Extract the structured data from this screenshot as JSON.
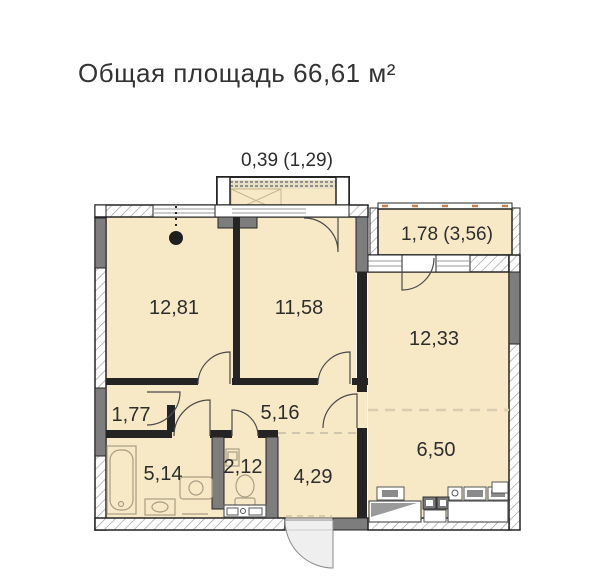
{
  "title": "Общая площадь 66,61 м²",
  "plan": {
    "balcony_top": {
      "label": "0,39 (1,29)"
    },
    "balcony_right": {
      "label": "1,78 (3,56)"
    },
    "rooms": [
      {
        "name": "bedroom-1",
        "area": "12,81"
      },
      {
        "name": "bedroom-2",
        "area": "11,58"
      },
      {
        "name": "living-room",
        "area": "12,33"
      },
      {
        "name": "entry-nook",
        "area": "1,77"
      },
      {
        "name": "corridor",
        "area": "5,16"
      },
      {
        "name": "kitchen",
        "area": "6,50"
      },
      {
        "name": "bathroom",
        "area": "5,14"
      },
      {
        "name": "wc",
        "area": "2,12"
      },
      {
        "name": "hallway",
        "area": "4,29"
      }
    ],
    "colors": {
      "room_fill": "#F8E9C6",
      "wall_gray": "#7D7D7D",
      "wall_black": "#242424",
      "railing_accent": "#C8804F"
    }
  }
}
